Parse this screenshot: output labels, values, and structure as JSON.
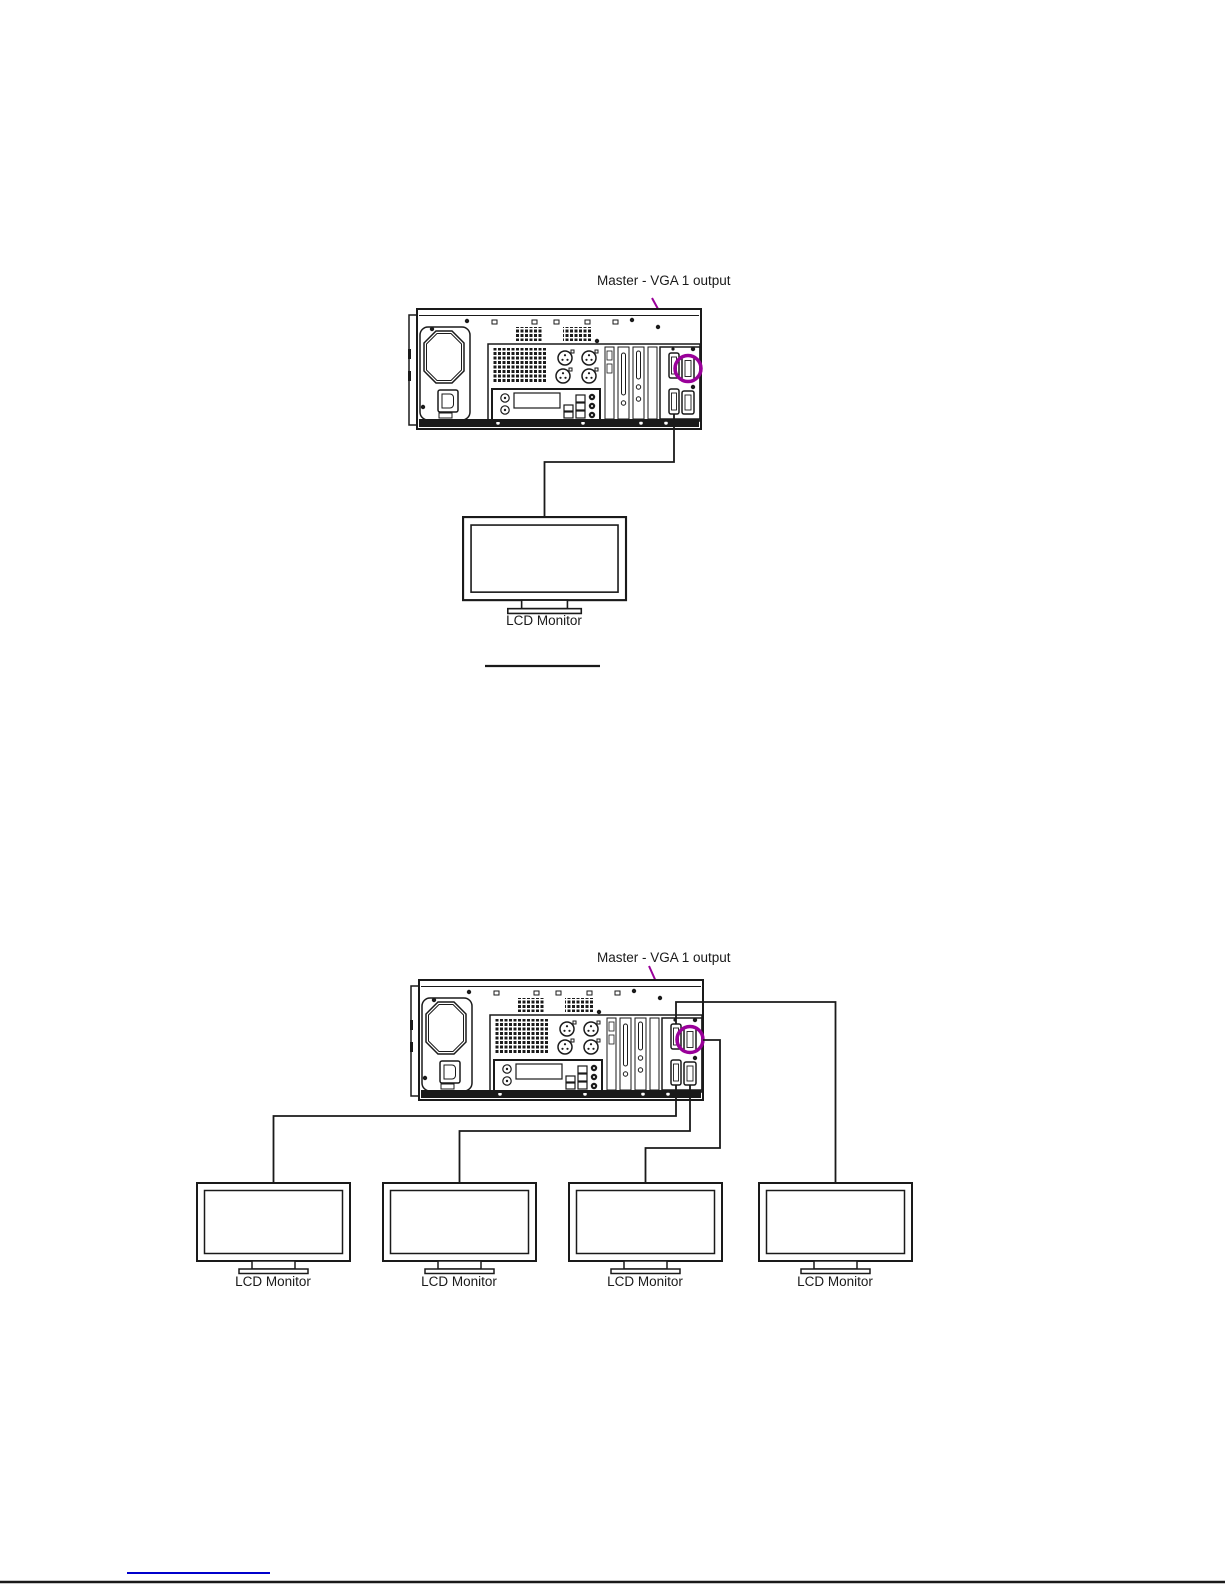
{
  "page": {
    "background": "#ffffff",
    "ink_color": "#1a1a1a",
    "highlight_color": "#990099",
    "footer_link_color": "#0000cc"
  },
  "diagram_single": {
    "port_label": "Master - VGA 1 output",
    "monitor_label": "LCD Monitor"
  },
  "diagram_quad": {
    "port_label": "Master - VGA 1 output",
    "monitor_labels": [
      "LCD Monitor",
      "LCD Monitor",
      "LCD Monitor",
      "LCD Monitor"
    ]
  }
}
